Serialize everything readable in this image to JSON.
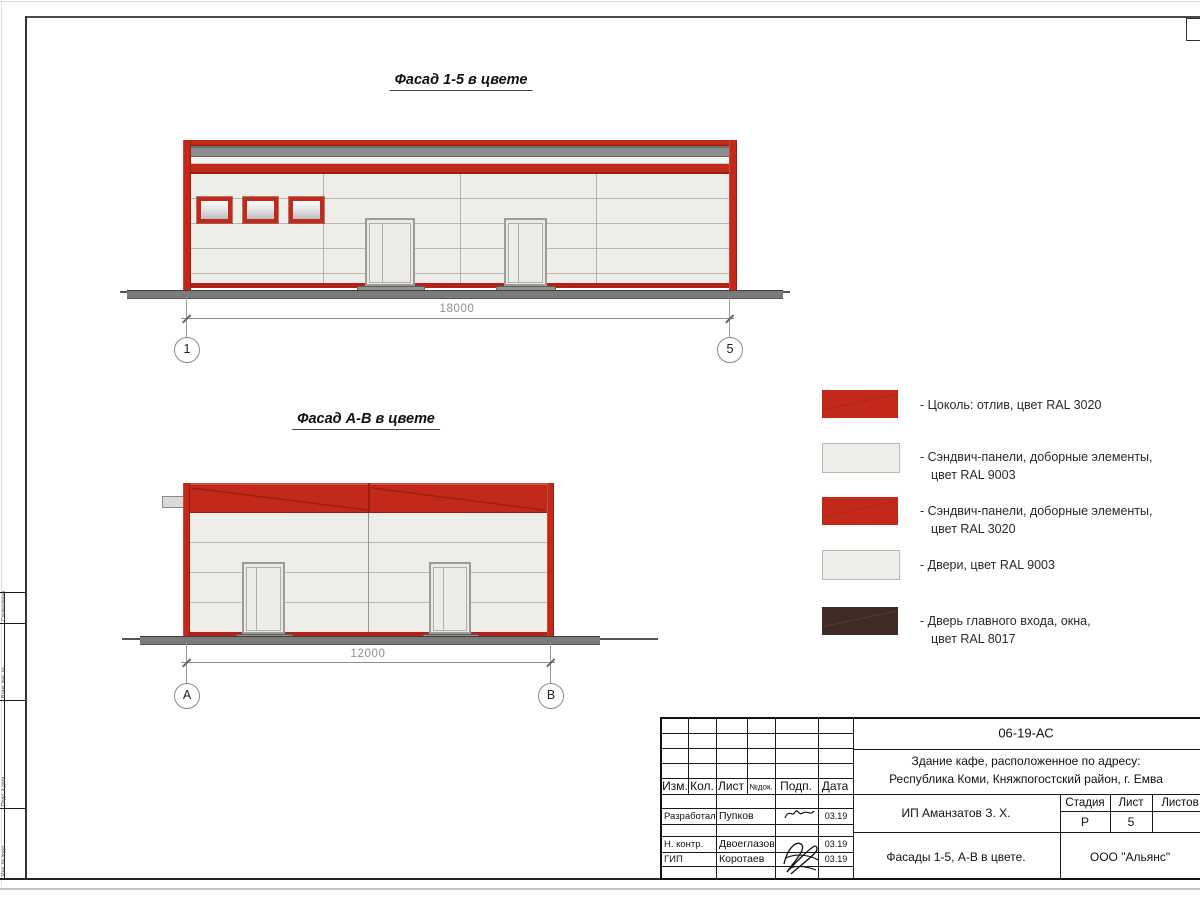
{
  "facades": [
    {
      "title": "Фасад 1-5 в цвете",
      "dimension": "18000",
      "axis_left": "1",
      "axis_right": "5"
    },
    {
      "title": "Фасад А-В в цвете",
      "dimension": "12000",
      "axis_left": "А",
      "axis_right": "В"
    }
  ],
  "legend": {
    "items": [
      {
        "swatch": "red",
        "lines": [
          "- Цоколь: отлив, цвет RAL 3020",
          ""
        ]
      },
      {
        "swatch": "white",
        "lines": [
          "- Сэндвич-панели, доборные элементы,",
          "цвет RAL 9003"
        ]
      },
      {
        "swatch": "red",
        "lines": [
          "- Сэндвич-панели, доборные элементы,",
          "цвет RAL 3020"
        ]
      },
      {
        "swatch": "white",
        "lines": [
          "- Двери, цвет RAL 9003",
          ""
        ]
      },
      {
        "swatch": "dark",
        "lines": [
          "- Дверь главного входа, окна,",
          "цвет RAL 8017"
        ]
      }
    ]
  },
  "title_block": {
    "code": "06-19-АС",
    "project_line1": "Здание кафе, расположенное по адресу:",
    "project_line2": "Республика Коми, Княжпогостский район, г. Емва",
    "client": "ИП Аманзатов З. Х.",
    "sheet_title": "Фасады 1-5, А-В в цвете.",
    "organization": "ООО \"Альянс\"",
    "stage_header": "Стадия",
    "sheet_header": "Лист",
    "sheets_header": "Листов",
    "stage_value": "Р",
    "sheet_value": "5",
    "rev_headers": [
      "Изм.",
      "Кол.",
      "Лист",
      "№док.",
      "Подп.",
      "Дата"
    ],
    "roles": [
      {
        "role": "Разработал",
        "name": "Пупков",
        "date": "03.19"
      },
      {
        "role": "Н. контр.",
        "name": "Двоеглазов",
        "date": "03.19"
      },
      {
        "role": "ГИП",
        "name": "Коротаев",
        "date": "03.19"
      }
    ]
  },
  "side_stamp": {
    "labels": [
      "Согласовано",
      "Взам. инв. №",
      "Подп. и дата",
      "Инв. № подл."
    ]
  },
  "colors": {
    "ral3020_red": "#c3291b",
    "ral9003_white": "#ededea",
    "ral8017_brown": "#3e2b23",
    "roof_gray": "#8d8d8d"
  }
}
